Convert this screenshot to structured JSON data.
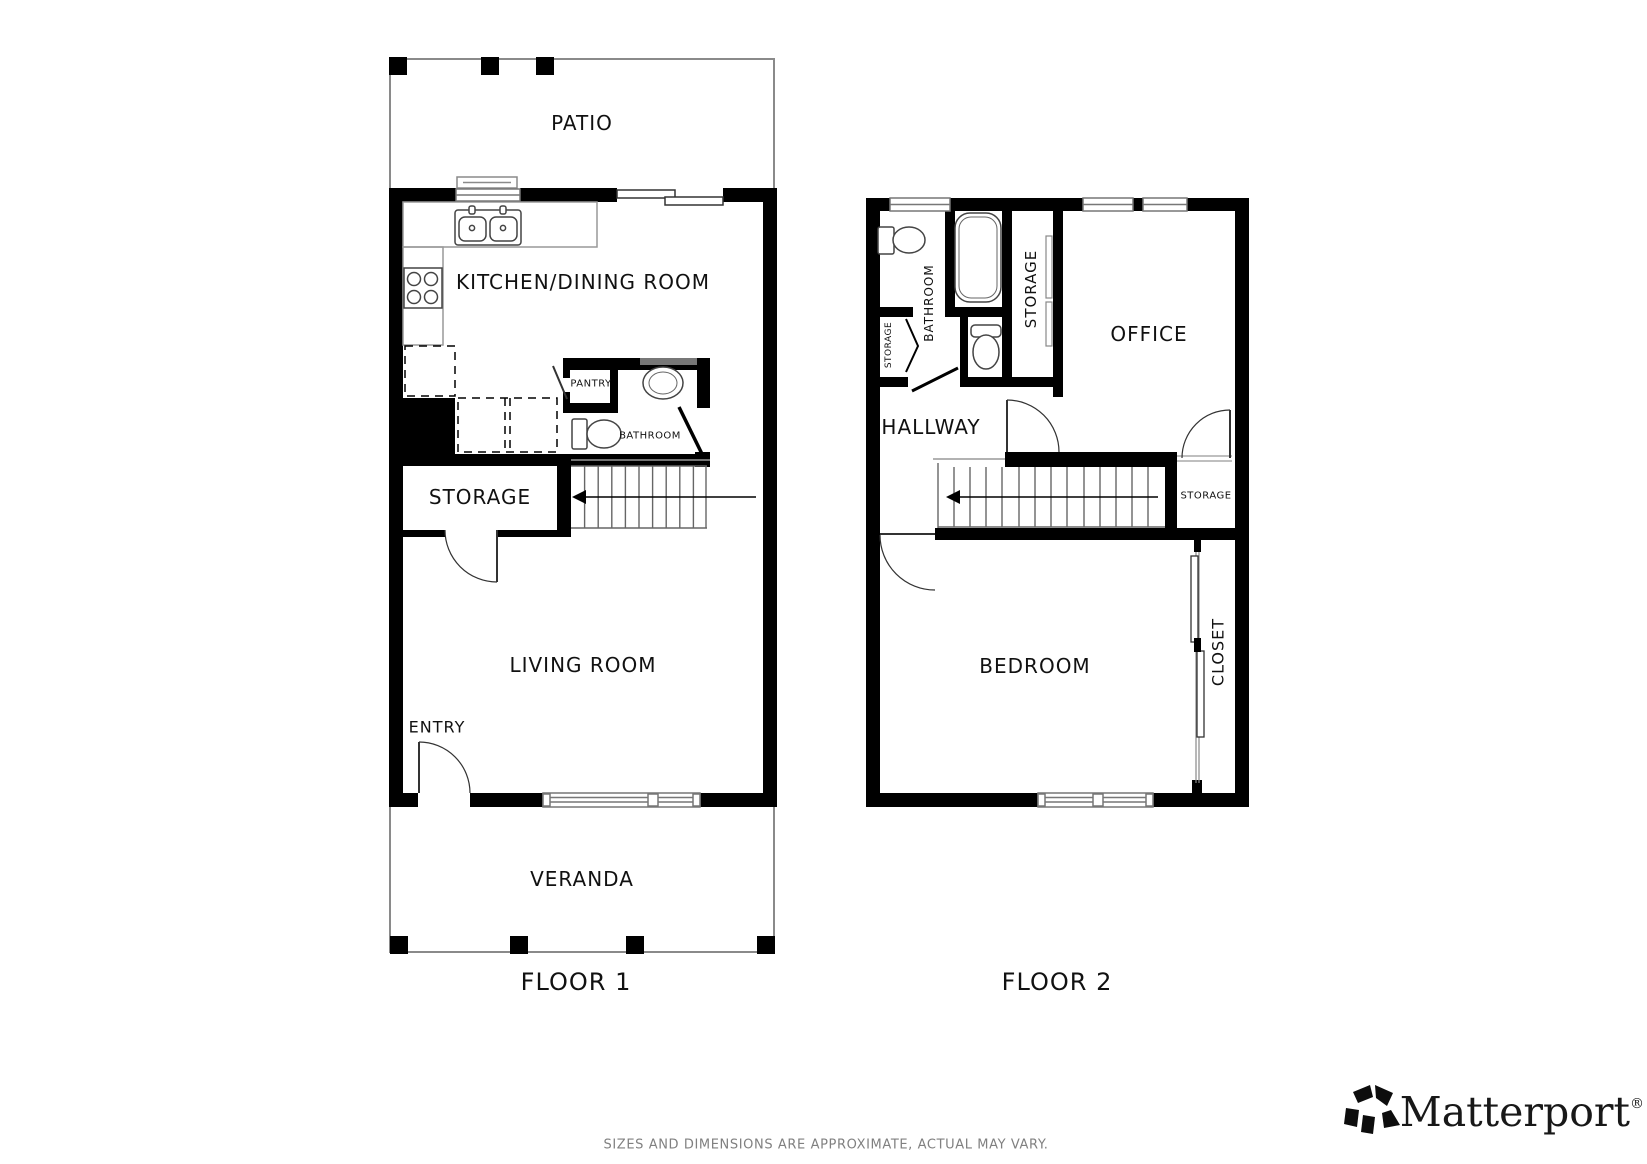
{
  "floor1": {
    "label": "FLOOR 1",
    "rooms": {
      "patio": "PATIO",
      "kitchen_dining": "KITCHEN/DINING ROOM",
      "pantry": "PANTRY",
      "bathroom": "BATHROOM",
      "storage": "STORAGE",
      "living_room": "LIVING ROOM",
      "entry": "ENTRY",
      "veranda": "VERANDA"
    }
  },
  "floor2": {
    "label": "FLOOR 2",
    "rooms": {
      "bathroom": "BATHROOM",
      "storage_bath": "STORAGE",
      "storage_upper": "STORAGE",
      "office": "OFFICE",
      "hallway": "HALLWAY",
      "storage_stairs": "STORAGE",
      "bedroom": "BEDROOM",
      "closet": "CLOSET"
    }
  },
  "footer": {
    "disclaimer": "SIZES AND DIMENSIONS ARE APPROXIMATE, ACTUAL MAY VARY.",
    "brand": "Matterport",
    "registered": "®"
  },
  "colors": {
    "wall": "#000000",
    "thin_line": "#888888",
    "stair_line": "#555555",
    "fixture_line": "#444444",
    "label": "#111111",
    "disclaimer": "#808080"
  }
}
